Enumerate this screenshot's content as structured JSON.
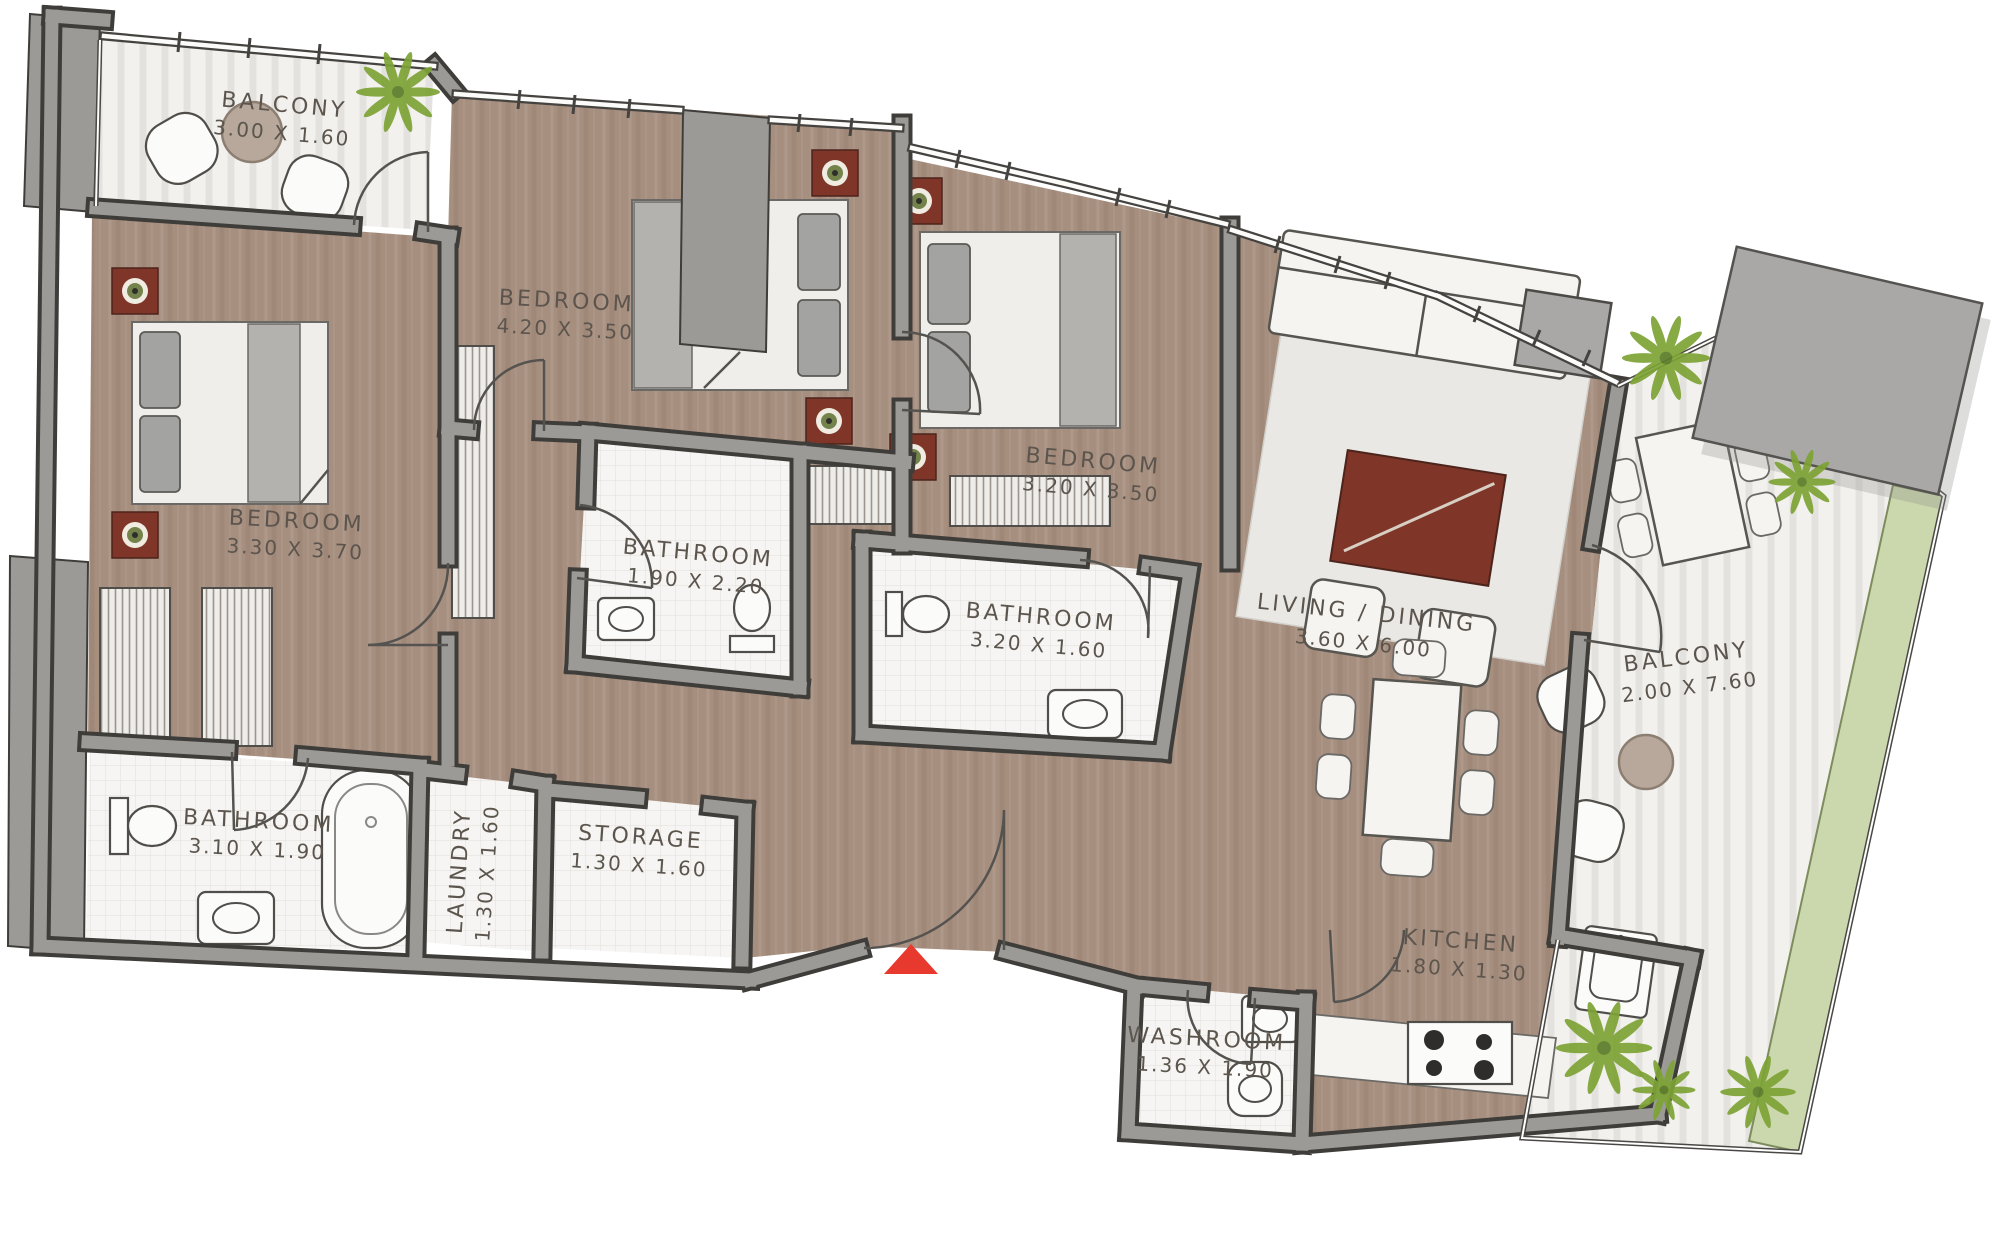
{
  "plan": {
    "type": "apartment-floor-plan",
    "entrance_marker": "red-triangle"
  },
  "palette": {
    "wood": "#a78f80",
    "wall": "#9b9a97",
    "wallLine": "#3f3d3a",
    "tile": "#f6f5f3",
    "balconyFloor": "#f2f1ee",
    "planter": "#cbd7ac",
    "plantGreen": "#7da335",
    "label": "#5c554d",
    "furnitureRed": "#7f3628",
    "entranceRed": "#e8392e",
    "grayBlock": "#a9a8a6"
  },
  "rooms": [
    {
      "name": "BALCONY",
      "dims": "3.00 X 1.60"
    },
    {
      "name": "BEDROOM",
      "dims": "3.30 X 3.70"
    },
    {
      "name": "BEDROOM",
      "dims": "4.20 X 3.50"
    },
    {
      "name": "BEDROOM",
      "dims": "3.20 X 3.50"
    },
    {
      "name": "BATHROOM",
      "dims": "1.90 X 2.20"
    },
    {
      "name": "BATHROOM",
      "dims": "3.20 X 1.60"
    },
    {
      "name": "LIVING / DINING",
      "dims": "3.60 X 6.00"
    },
    {
      "name": "BALCONY",
      "dims": "2.00 X 7.60"
    },
    {
      "name": "BATHROOM",
      "dims": "3.10 X 1.90"
    },
    {
      "name": "LAUNDRY",
      "dims": "1.30 X 1.60"
    },
    {
      "name": "STORAGE",
      "dims": "1.30 X 1.60"
    },
    {
      "name": "KITCHEN",
      "dims": "1.80 X 1.30"
    },
    {
      "name": "WASHROOM",
      "dims": "1.36 X 1.90"
    }
  ]
}
